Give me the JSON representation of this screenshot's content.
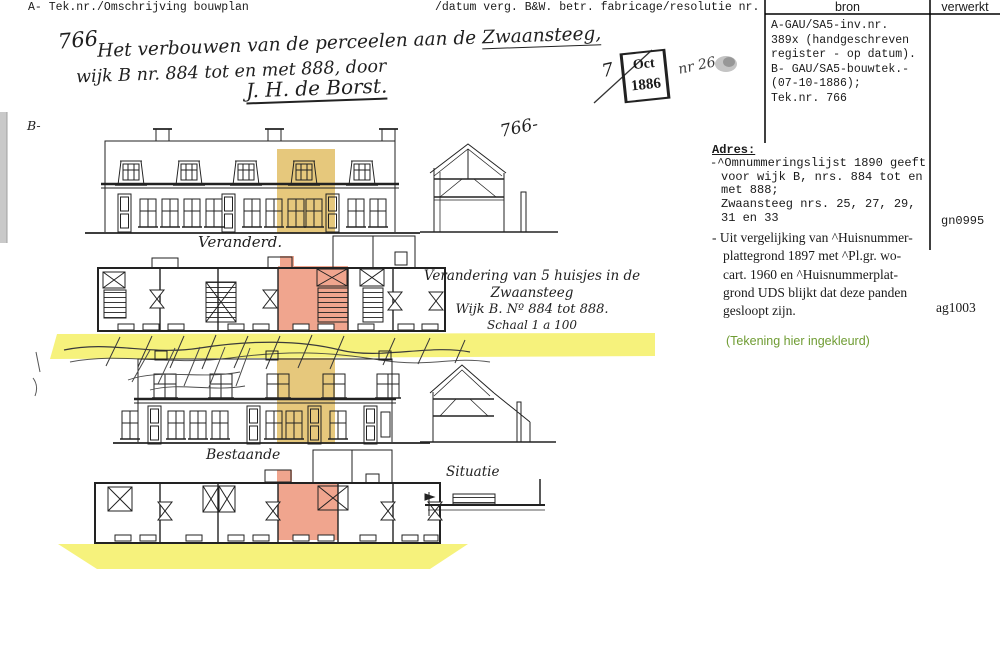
{
  "document": {
    "header_left": "A- Tek.nr./Omschrijving bouwplan",
    "header_right": "/datum verg. B&W. betr. fabricage/resolutie nr."
  },
  "bron_table": {
    "col_bron": "bron",
    "col_verwerkt": "verwerkt",
    "lines": [
      "A-GAU/SA5-inv.nr.",
      "389x (handgeschreven",
      "register - op datum).",
      "B- GAU/SA5-bouwtek.-",
      "(07-10-1886);",
      "Tek.nr. 766"
    ]
  },
  "handwriting": {
    "tek_nr": "766",
    "desc_line1": "Het verbouwen van de perceelen aan de ",
    "street": "Zwaansteeg,",
    "desc_line2": "wijk B nr. 884 tot en met 888, door",
    "signature": "J. H. de Borst.",
    "section_letter": "B-",
    "drawing_number": "766-",
    "label_veranderd": "Veranderd.",
    "label_bestaande": "Bestaande",
    "label_situatie": "Situatie",
    "caption_line1": "Verandering van 5 huisjes in de Zwaansteeg",
    "caption_line2": "Wijk B. Nº 884 tot 888.",
    "caption_line3": "Schaal 1 a 100"
  },
  "stamp": {
    "day": "7",
    "month": "Oct",
    "year": "1886",
    "number": "nr 26"
  },
  "adres": {
    "heading": "Adres:",
    "block1": [
      "-^Omnummeringslijst 1890 geeft",
      "voor wijk B, nrs. 884 tot en",
      "met 888;",
      "Zwaansteeg nrs. 25, 27, 29,",
      "31 en 33"
    ],
    "code1": "gn0995",
    "block2": [
      "- Uit vergelijking van ^Huisnummer-",
      "plattegrond 1897 met ^Pl.gr. wo-",
      "cart. 1960 en ^Huisnummerplat-",
      "grond UDS blijkt dat deze panden",
      "gesloopt zijn."
    ],
    "code2": "ag1003",
    "note": "(Tekening hier ingekleurd)"
  },
  "colors": {
    "highlight_yellow": "#f6f27c",
    "highlight_tan": "#e6c87c",
    "highlight_salmon": "#f0a58e",
    "note_green": "#6f9c33"
  }
}
